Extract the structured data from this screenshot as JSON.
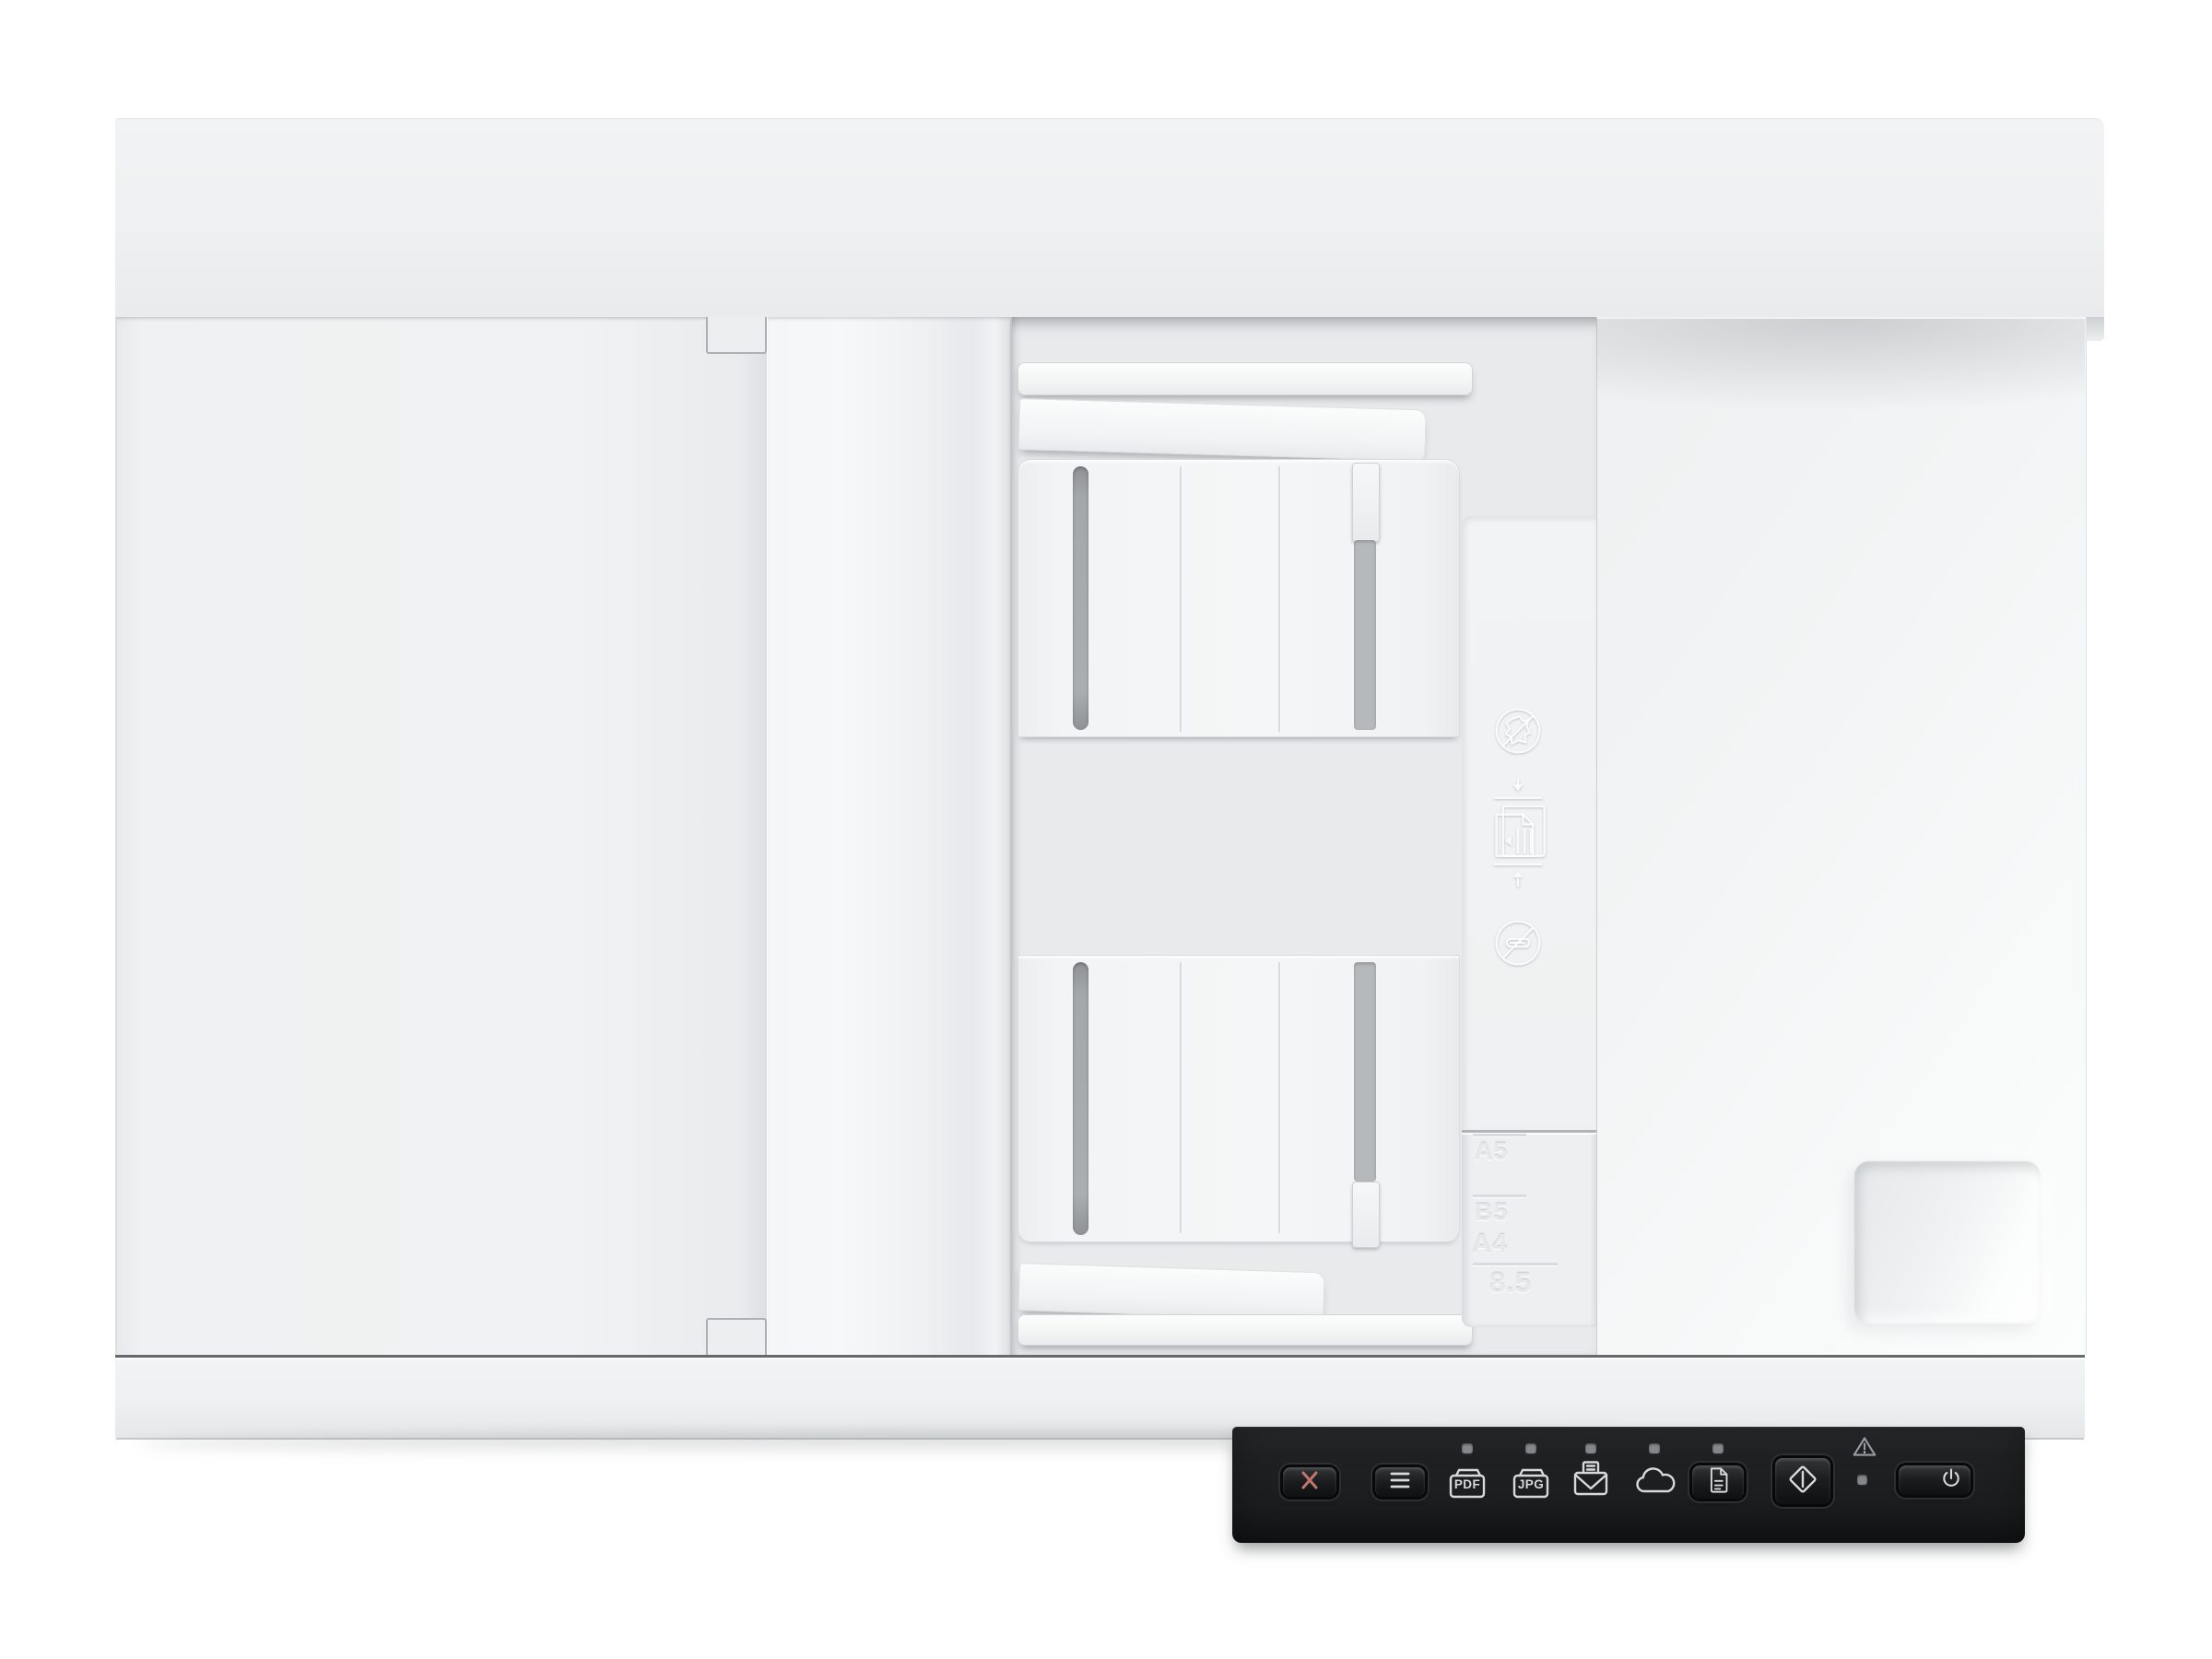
{
  "device": {
    "kind": "document scanner with automatic document feeder, top view"
  },
  "colors": {
    "bg": "#ffffff",
    "panel_bg": "#1e1f21",
    "glyph": "#d7d9da",
    "cancel_glyph": "#c1766d",
    "led": "#84888b",
    "warn": "#999da0",
    "body_white": "#f0f2f3"
  },
  "control_panel": {
    "buttons": [
      {
        "id": "cancel",
        "icon": "x-cancel-icon",
        "type": "raised-button"
      },
      {
        "id": "menu",
        "icon": "menu-lines-icon",
        "type": "raised-button"
      },
      {
        "id": "pdf",
        "icon": "folder-pdf-icon",
        "label": "PDF",
        "type": "destination-indicator",
        "led": true
      },
      {
        "id": "jpg",
        "icon": "folder-jpg-icon",
        "label": "JPG",
        "type": "destination-indicator",
        "led": true
      },
      {
        "id": "email",
        "icon": "scan-to-email-icon",
        "type": "destination-indicator",
        "led": true
      },
      {
        "id": "cloud",
        "icon": "cloud-icon",
        "type": "destination-indicator",
        "led": true
      },
      {
        "id": "document",
        "icon": "document-page-icon",
        "type": "raised-button",
        "led": true
      },
      {
        "id": "start",
        "icon": "start-scan-diamond-icon",
        "type": "raised-button"
      },
      {
        "id": "power",
        "icon": "power-icon",
        "type": "raised-button"
      }
    ],
    "warning_indicator": {
      "icon": "warning-triangle-icon",
      "led": true
    }
  },
  "adf_markings": {
    "icons": [
      "no-crumpled-paper",
      "load-original-stack",
      "no-paperclips"
    ],
    "paper_sizes": [
      "A5",
      "B5",
      "A4",
      "8.5"
    ]
  }
}
